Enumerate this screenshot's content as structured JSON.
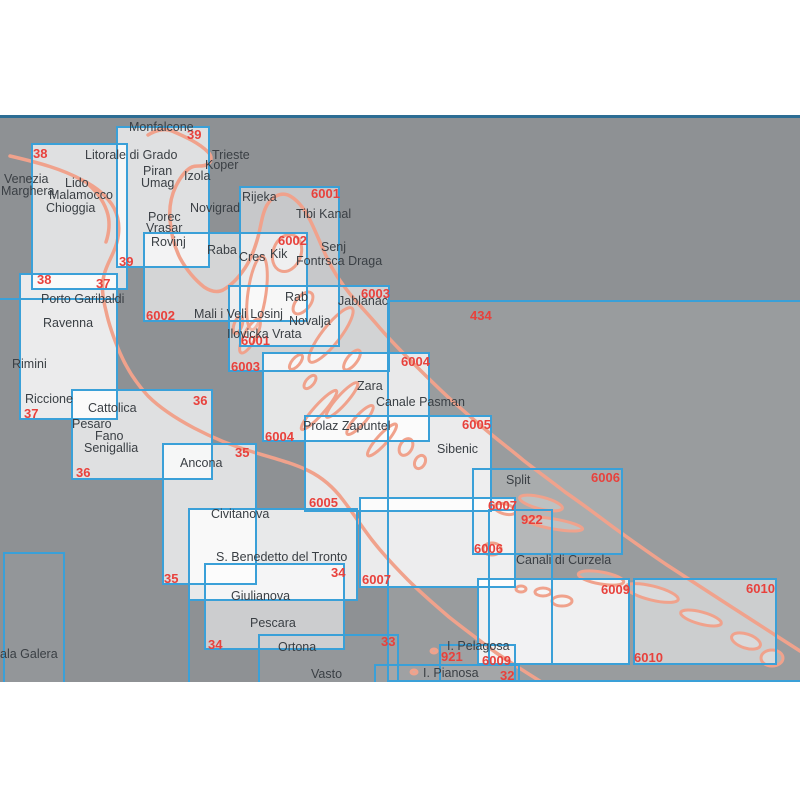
{
  "map": {
    "colors": {
      "background": "#8e9194",
      "chart_border": "#3aa0d8",
      "chart_number_red": "#e8413c",
      "coastline": "#f0a28c",
      "divider_blue": "#2c6d94",
      "place_text": "#3a3f44"
    },
    "charts": [
      {
        "id": "434",
        "x": 387,
        "y": 300,
        "w": 423,
        "h": 382,
        "a": 0.1
      },
      {
        "id": "39",
        "x": 116,
        "y": 126,
        "w": 94,
        "h": 142,
        "a": 0.72
      },
      {
        "id": "38",
        "x": 31,
        "y": 143,
        "w": 97,
        "h": 147,
        "a": 0.72
      },
      {
        "id": "37",
        "x": 19,
        "y": 273,
        "w": 99,
        "h": 147,
        "a": 0.82
      },
      {
        "id": "6001",
        "x": 239,
        "y": 186,
        "w": 101,
        "h": 161,
        "a": 0.5
      },
      {
        "id": "6002",
        "x": 143,
        "y": 232,
        "w": 165,
        "h": 90,
        "a": 0.62
      },
      {
        "id": "6003",
        "x": 228,
        "y": 285,
        "w": 162,
        "h": 87,
        "a": 0.6
      },
      {
        "id": "6004",
        "x": 262,
        "y": 352,
        "w": 168,
        "h": 90,
        "a": 0.78
      },
      {
        "id": "36",
        "x": 71,
        "y": 389,
        "w": 142,
        "h": 91,
        "a": 0.72
      },
      {
        "id": "6005",
        "x": 304,
        "y": 415,
        "w": 188,
        "h": 97,
        "a": 0.8
      },
      {
        "id": "35",
        "x": 162,
        "y": 443,
        "w": 95,
        "h": 142,
        "a": 0.72
      },
      {
        "id": "unlabeled",
        "x": 188,
        "y": 508,
        "w": 170,
        "h": 93,
        "a": 0.8
      },
      {
        "id": "6006",
        "x": 472,
        "y": 468,
        "w": 151,
        "h": 87,
        "a": 0.16
      },
      {
        "id": "6007",
        "x": 359,
        "y": 497,
        "w": 157,
        "h": 91,
        "a": 0.82
      },
      {
        "id": "922",
        "x": 488,
        "y": 509,
        "w": 65,
        "h": 156,
        "a": 0.14
      },
      {
        "id": "34",
        "x": 204,
        "y": 563,
        "w": 141,
        "h": 87,
        "a": 0.55
      },
      {
        "id": "33",
        "x": 258,
        "y": 634,
        "w": 141,
        "h": 60,
        "a": 0.06
      },
      {
        "id": "921",
        "x": 439,
        "y": 644,
        "w": 77,
        "h": 50,
        "a": 0.06
      },
      {
        "id": "32",
        "x": 374,
        "y": 664,
        "w": 146,
        "h": 30,
        "a": 0.06
      },
      {
        "id": "6009",
        "x": 477,
        "y": 578,
        "w": 153,
        "h": 87,
        "a": 0.85
      },
      {
        "id": "6010",
        "x": 633,
        "y": 578,
        "w": 144,
        "h": 87,
        "a": 0.5
      },
      {
        "id": "partial-left",
        "x": 3,
        "y": 552,
        "w": 62,
        "h": 140,
        "a": 0.05
      }
    ],
    "edges": [
      {
        "x": 0,
        "y": 298,
        "w": 116
      },
      {
        "x": 188,
        "y": 601,
        "h": 81
      }
    ],
    "chart_numbers": [
      {
        "t": "38",
        "x": 33,
        "y": 146
      },
      {
        "t": "39",
        "x": 187,
        "y": 127
      },
      {
        "t": "6001",
        "x": 311,
        "y": 186
      },
      {
        "t": "6002",
        "x": 278,
        "y": 233
      },
      {
        "t": "39",
        "x": 119,
        "y": 254
      },
      {
        "t": "38",
        "x": 37,
        "y": 272
      },
      {
        "t": "37",
        "x": 96,
        "y": 276
      },
      {
        "t": "6003",
        "x": 361,
        "y": 286
      },
      {
        "t": "434",
        "x": 470,
        "y": 308
      },
      {
        "t": "6002",
        "x": 146,
        "y": 308
      },
      {
        "t": "6001",
        "x": 241,
        "y": 333
      },
      {
        "t": "6004",
        "x": 401,
        "y": 354
      },
      {
        "t": "6003",
        "x": 231,
        "y": 359
      },
      {
        "t": "36",
        "x": 193,
        "y": 393
      },
      {
        "t": "37",
        "x": 24,
        "y": 406
      },
      {
        "t": "6005",
        "x": 462,
        "y": 417
      },
      {
        "t": "6004",
        "x": 265,
        "y": 429
      },
      {
        "t": "35",
        "x": 235,
        "y": 445
      },
      {
        "t": "36",
        "x": 76,
        "y": 465
      },
      {
        "t": "6006",
        "x": 591,
        "y": 470
      },
      {
        "t": "6005",
        "x": 309,
        "y": 495
      },
      {
        "t": "6007",
        "x": 488,
        "y": 498
      },
      {
        "t": "922",
        "x": 521,
        "y": 512
      },
      {
        "t": "6006",
        "x": 474,
        "y": 541
      },
      {
        "t": "34",
        "x": 331,
        "y": 565
      },
      {
        "t": "35",
        "x": 164,
        "y": 571
      },
      {
        "t": "6007",
        "x": 362,
        "y": 572
      },
      {
        "t": "6009",
        "x": 601,
        "y": 582
      },
      {
        "t": "6010",
        "x": 746,
        "y": 581
      },
      {
        "t": "33",
        "x": 381,
        "y": 634
      },
      {
        "t": "34",
        "x": 208,
        "y": 637
      },
      {
        "t": "6010",
        "x": 634,
        "y": 650
      },
      {
        "t": "921",
        "x": 441,
        "y": 649
      },
      {
        "t": "6009",
        "x": 482,
        "y": 653
      },
      {
        "t": "32",
        "x": 500,
        "y": 668
      }
    ],
    "place_names": [
      {
        "t": "Monfalcone",
        "x": 129,
        "y": 120
      },
      {
        "t": "Litorale di Grado",
        "x": 85,
        "y": 148
      },
      {
        "t": "Trieste",
        "x": 212,
        "y": 148
      },
      {
        "t": "Koper",
        "x": 205,
        "y": 158
      },
      {
        "t": "Piran",
        "x": 143,
        "y": 164
      },
      {
        "t": "Izola",
        "x": 184,
        "y": 169
      },
      {
        "t": "Venezia",
        "x": 4,
        "y": 172
      },
      {
        "t": "Lido",
        "x": 65,
        "y": 176
      },
      {
        "t": "Umag",
        "x": 141,
        "y": 176
      },
      {
        "t": "Marghera",
        "x": 1,
        "y": 184
      },
      {
        "t": "Malamocco",
        "x": 49,
        "y": 188
      },
      {
        "t": "Rijeka",
        "x": 242,
        "y": 190
      },
      {
        "t": "Chioggia",
        "x": 46,
        "y": 201
      },
      {
        "t": "Novigrad",
        "x": 190,
        "y": 201
      },
      {
        "t": "Tibi Kanal",
        "x": 296,
        "y": 207
      },
      {
        "t": "Porec",
        "x": 148,
        "y": 210
      },
      {
        "t": "Vrasar",
        "x": 146,
        "y": 221
      },
      {
        "t": "Rovinj",
        "x": 151,
        "y": 235
      },
      {
        "t": "Senj",
        "x": 321,
        "y": 240
      },
      {
        "t": "Raba",
        "x": 207,
        "y": 243
      },
      {
        "t": "Kik",
        "x": 270,
        "y": 247
      },
      {
        "t": "Cres",
        "x": 239,
        "y": 250
      },
      {
        "t": "Fontrsca Draga",
        "x": 296,
        "y": 254
      },
      {
        "t": "Rab",
        "x": 285,
        "y": 290
      },
      {
        "t": "Porto Garibaldi",
        "x": 41,
        "y": 292
      },
      {
        "t": "Jablanac",
        "x": 338,
        "y": 294
      },
      {
        "t": "Mali i Veli Losinj",
        "x": 194,
        "y": 307
      },
      {
        "t": "Novalja",
        "x": 289,
        "y": 314
      },
      {
        "t": "Ravenna",
        "x": 43,
        "y": 316
      },
      {
        "t": "Ilovicka Vrata",
        "x": 227,
        "y": 327
      },
      {
        "t": "Rimini",
        "x": 12,
        "y": 357
      },
      {
        "t": "Zara",
        "x": 357,
        "y": 379
      },
      {
        "t": "Riccione",
        "x": 25,
        "y": 392
      },
      {
        "t": "Canale Pasman",
        "x": 376,
        "y": 395
      },
      {
        "t": "Cattolica",
        "x": 88,
        "y": 401
      },
      {
        "t": "Pesaro",
        "x": 72,
        "y": 417
      },
      {
        "t": "Prolaz Zapuntel",
        "x": 303,
        "y": 419
      },
      {
        "t": "Fano",
        "x": 95,
        "y": 429
      },
      {
        "t": "Senigallia",
        "x": 84,
        "y": 441
      },
      {
        "t": "Sibenic",
        "x": 437,
        "y": 442
      },
      {
        "t": "Ancona",
        "x": 180,
        "y": 456
      },
      {
        "t": "Split",
        "x": 506,
        "y": 473
      },
      {
        "t": "Civitanova",
        "x": 211,
        "y": 507
      },
      {
        "t": "S. Benedetto del Tronto",
        "x": 216,
        "y": 550
      },
      {
        "t": "Canali di Curzela",
        "x": 516,
        "y": 553
      },
      {
        "t": "Giulianova",
        "x": 231,
        "y": 589
      },
      {
        "t": "Pescara",
        "x": 250,
        "y": 616
      },
      {
        "t": "Ortona",
        "x": 278,
        "y": 640
      },
      {
        "t": "I. Pelagosa",
        "x": 447,
        "y": 639
      },
      {
        "t": "ala Galera",
        "x": 0,
        "y": 647
      },
      {
        "t": "I. Pianosa",
        "x": 423,
        "y": 666
      },
      {
        "t": "Vasto",
        "x": 311,
        "y": 667
      }
    ]
  }
}
